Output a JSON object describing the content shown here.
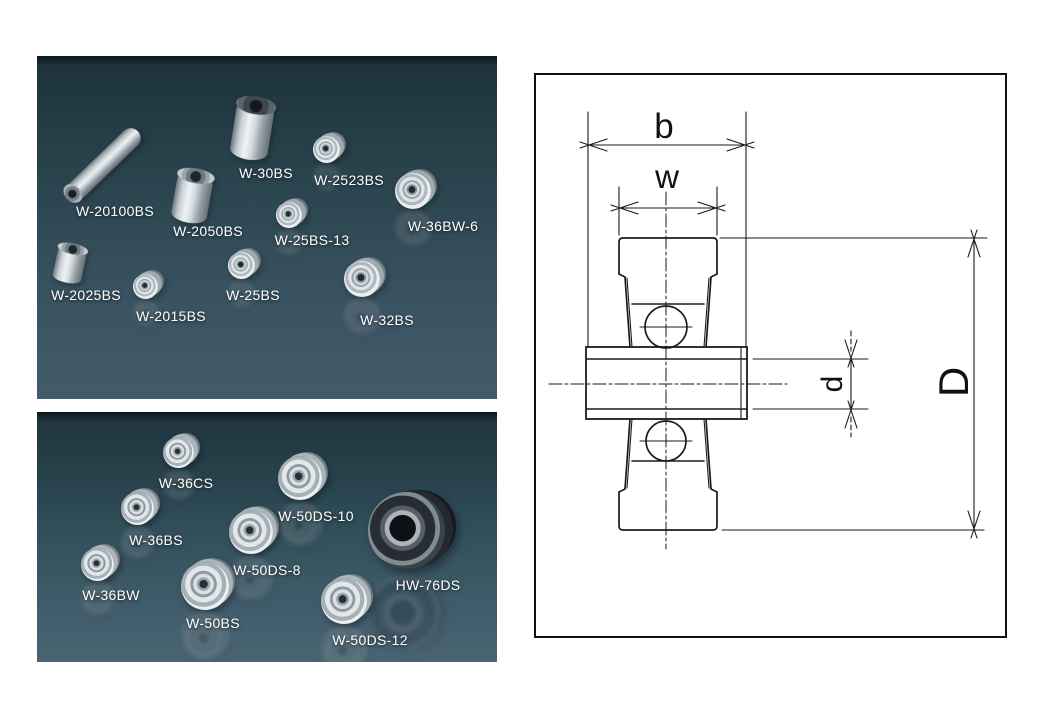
{
  "panels": {
    "top": {
      "items": [
        {
          "label": "W-20100BS"
        },
        {
          "label": "W-30BS"
        },
        {
          "label": "W-2523BS"
        },
        {
          "label": "W-36BW-6"
        },
        {
          "label": "W-2050BS"
        },
        {
          "label": "W-25BS-13"
        },
        {
          "label": "W-2025BS"
        },
        {
          "label": "W-2015BS"
        },
        {
          "label": "W-25BS"
        },
        {
          "label": "W-32BS"
        }
      ]
    },
    "bottom": {
      "items": [
        {
          "label": "W-36CS"
        },
        {
          "label": "W-50DS-10"
        },
        {
          "label": "W-36BS"
        },
        {
          "label": "W-50DS-8"
        },
        {
          "label": "HW-76DS"
        },
        {
          "label": "W-36BW"
        },
        {
          "label": "W-50BS"
        },
        {
          "label": "W-50DS-12"
        }
      ]
    }
  },
  "diagram": {
    "labels": {
      "b": "b",
      "w": "w",
      "d": "d",
      "D": "D"
    }
  },
  "colors": {
    "page_background": "#ffffff",
    "panel_gradient_top": "#0c171c",
    "panel_gradient_bottom": "#4a6472",
    "product_label_text": "#ffffff",
    "diagram_line": "#1b1b1b",
    "metal_highlight": "#eef2f4",
    "metal_shadow": "#5f6a72"
  }
}
